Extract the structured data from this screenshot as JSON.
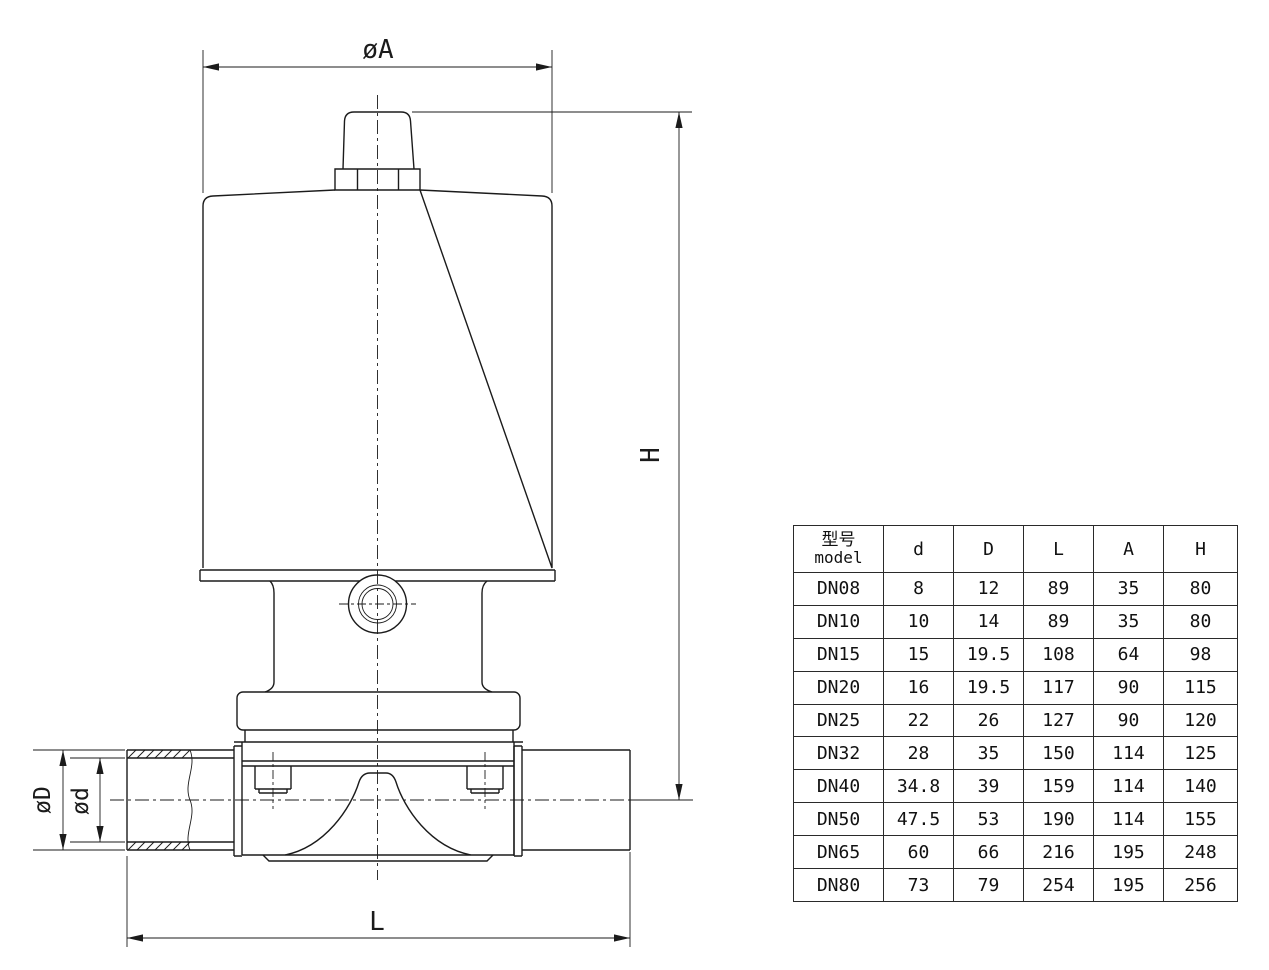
{
  "drawing": {
    "labels": {
      "diameter_a": "øA",
      "height_h": "H",
      "diameter_outer": "øD",
      "diameter_inner": "ød",
      "length_l": "L"
    },
    "line_color": "#1b1b1b"
  },
  "table": {
    "header": {
      "model_zh": "型号",
      "model_en": "model",
      "d": "d",
      "D": "D",
      "L": "L",
      "A": "A",
      "H": "H"
    },
    "rows": [
      {
        "model": "DN08",
        "d": "8",
        "D": "12",
        "L": "89",
        "A": "35",
        "H": "80",
        "bold": true
      },
      {
        "model": "DN10",
        "d": "10",
        "D": "14",
        "L": "89",
        "A": "35",
        "H": "80",
        "bold": true
      },
      {
        "model": "DN15",
        "d": "15",
        "D": "19.5",
        "L": "108",
        "A": "64",
        "H": "98",
        "bold": false
      },
      {
        "model": "DN20",
        "d": "16",
        "D": "19.5",
        "L": "117",
        "A": "90",
        "H": "115",
        "bold": false
      },
      {
        "model": "DN25",
        "d": "22",
        "D": "26",
        "L": "127",
        "A": "90",
        "H": "120",
        "bold": false
      },
      {
        "model": "DN32",
        "d": "28",
        "D": "35",
        "L": "150",
        "A": "114",
        "H": "125",
        "bold": false
      },
      {
        "model": "DN40",
        "d": "34.8",
        "D": "39",
        "L": "159",
        "A": "114",
        "H": "140",
        "bold": false
      },
      {
        "model": "DN50",
        "d": "47.5",
        "D": "53",
        "L": "190",
        "A": "114",
        "H": "155",
        "bold": false
      },
      {
        "model": "DN65",
        "d": "60",
        "D": "66",
        "L": "216",
        "A": "195",
        "H": "248",
        "bold": false
      },
      {
        "model": "DN80",
        "d": "73",
        "D": "79",
        "L": "254",
        "A": "195",
        "H": "256",
        "bold": false
      }
    ]
  }
}
